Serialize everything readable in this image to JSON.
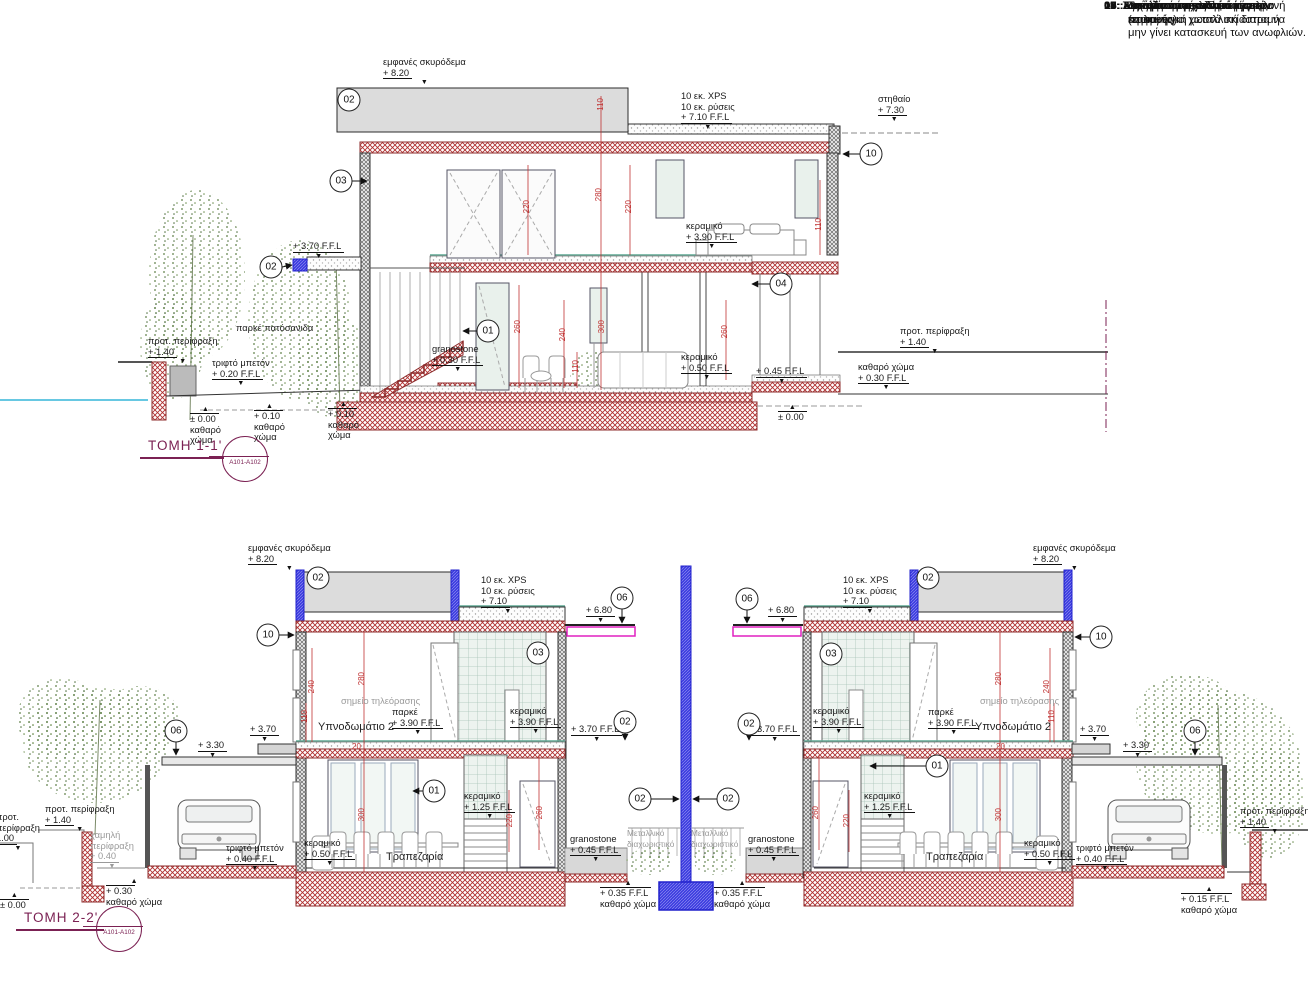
{
  "notes": {
    "items": [
      {
        "num": "04 :",
        "text": "Επένδυση φυσικής πέτρας επιλογής"
      },
      {
        "num": "05 :",
        "text": ":Διάτρητη τοιχοποιία."
      },
      {
        "num": "06:",
        "text": "Μεταλλικό στέγαστρο με εμφανή περιμετρική μεταλλική διατομή"
      },
      {
        "num": "07:",
        "text": "Συρόμενο μεταλλικό κάγκελο."
      },
      {
        "num": "08:",
        "text": "Ανοιγόμενο μεταλλικό κάγκελο."
      },
      {
        "num": "09:",
        "text": "Εγκατάσταση κουπαστής."
      },
      {
        "num": "10:",
        "text": "Σε περίπτωση εγκατάστασης κουτιών για χωστά σκίαστρα να μην γίνει κατασκευή των ανωφλιών."
      },
      {
        "num": "11:",
        "text": "Τοιχοία από σανιδωτό  μπετόν (εμφανές)"
      }
    ]
  },
  "sections": {
    "s1": {
      "title": "ΤΟΜΗ 1-1'",
      "ref": "A101-A102",
      "circles": [
        {
          "n": "02",
          "x": 349,
          "y": 100
        },
        {
          "n": "03",
          "x": 341,
          "y": 181
        },
        {
          "n": "02",
          "x": 271,
          "y": 267
        },
        {
          "n": "01",
          "x": 488,
          "y": 331
        },
        {
          "n": "04",
          "x": 781,
          "y": 284
        },
        {
          "n": "10",
          "x": 871,
          "y": 154
        }
      ],
      "levels": [
        {
          "name": "εμφανές σκυρόδεμα",
          "value": "+ 8.20",
          "x": 383,
          "y": 57,
          "marker": "down"
        },
        {
          "name": "10 εκ. XPS",
          "name2": "10 εκ. ρύσεις",
          "value": "+ 7.10 F.F.L",
          "x": 681,
          "y": 91,
          "marker": "down"
        },
        {
          "name": "στηθαίο",
          "value": "+ 7.30",
          "x": 878,
          "y": 94,
          "marker": "down"
        },
        {
          "value": "+ 3.70 F.F.L",
          "x": 293,
          "y": 241,
          "marker": "down"
        },
        {
          "name": "κεραμικό",
          "value": "+ 3.90 F.F.L",
          "x": 686,
          "y": 221,
          "marker": "down"
        },
        {
          "name": "κεραμικό",
          "value": "+ 0.50 F.F.L",
          "x": 681,
          "y": 352,
          "marker": "down"
        },
        {
          "value": "+ 0.45 F.F.L",
          "x": 756,
          "y": 366,
          "marker": "down"
        },
        {
          "name": "καθαρό χώμα",
          "value": "+ 0.30 F.F.L",
          "x": 858,
          "y": 362,
          "marker": "down"
        },
        {
          "name": "προτ. περίφραξη",
          "value": "+ 1.40",
          "x": 900,
          "y": 326,
          "marker": "down"
        },
        {
          "value": "± 0.00",
          "x": 778,
          "y": 404,
          "marker": "up"
        },
        {
          "name": "προτ. περίφραξη",
          "value": "+ 1.40",
          "x": 148,
          "y": 336,
          "marker": "down"
        },
        {
          "name": "τριφτό μπετόν",
          "value": "+ 0.20 F.F.L",
          "x": 212,
          "y": 358,
          "marker": "down"
        },
        {
          "name": "granostone",
          "value": "+ 0.30 F.F.L",
          "x": 432,
          "y": 344,
          "marker": "down"
        },
        {
          "value": "± 0.00",
          "below": "καθαρό",
          "below2": "χώμα",
          "x": 190,
          "y": 406,
          "marker": "up"
        },
        {
          "value": "+ 0.10",
          "below": "καθαρό",
          "below2": "χώμα",
          "x": 254,
          "y": 403,
          "marker": "up"
        },
        {
          "value": "+ 0.10",
          "below": "καθαρό",
          "below2": "χώμα",
          "x": 328,
          "y": 401,
          "marker": "up"
        }
      ],
      "dims": [
        {
          "v": "110",
          "x": 596,
          "y": 98,
          "rot": true
        },
        {
          "v": "220",
          "x": 522,
          "y": 200,
          "rot": true
        },
        {
          "v": "280",
          "x": 594,
          "y": 188,
          "rot": true
        },
        {
          "v": "220",
          "x": 624,
          "y": 200,
          "rot": true
        },
        {
          "v": "110",
          "x": 814,
          "y": 218,
          "rot": true
        },
        {
          "v": "260",
          "x": 513,
          "y": 320,
          "rot": true
        },
        {
          "v": "240",
          "x": 558,
          "y": 328,
          "rot": true
        },
        {
          "v": "110",
          "x": 571,
          "y": 360,
          "rot": true
        },
        {
          "v": "300",
          "x": 597,
          "y": 320,
          "rot": true
        },
        {
          "v": "260",
          "x": 720,
          "y": 325,
          "rot": true
        }
      ],
      "texts": [
        {
          "t": "παρκέ πατόσανιδα",
          "x": 236,
          "y": 323
        }
      ]
    },
    "s2": {
      "title": "ΤΟΜΗ 2-2'",
      "ref": "A101-A102",
      "circles": [
        {
          "n": "02",
          "x": 318,
          "y": 578
        },
        {
          "n": "10",
          "x": 268,
          "y": 635
        },
        {
          "n": "06",
          "x": 622,
          "y": 598
        },
        {
          "n": "06",
          "x": 176,
          "y": 731
        },
        {
          "n": "03",
          "x": 538,
          "y": 653
        },
        {
          "n": "01",
          "x": 434,
          "y": 791
        },
        {
          "n": "02",
          "x": 625,
          "y": 722
        },
        {
          "n": "02",
          "x": 640,
          "y": 799
        },
        {
          "n": "02",
          "x": 928,
          "y": 578
        },
        {
          "n": "10",
          "x": 1101,
          "y": 637
        },
        {
          "n": "06",
          "x": 747,
          "y": 599
        },
        {
          "n": "06",
          "x": 1195,
          "y": 731
        },
        {
          "n": "03",
          "x": 831,
          "y": 654
        },
        {
          "n": "01",
          "x": 937,
          "y": 766
        },
        {
          "n": "02",
          "x": 749,
          "y": 724
        },
        {
          "n": "02",
          "x": 728,
          "y": 799
        }
      ],
      "levels": [
        {
          "name": "εμφανές σκυρόδεμα",
          "value": "+ 8.20",
          "x": 248,
          "y": 543,
          "marker": "down"
        },
        {
          "name": "10 εκ. XPS",
          "name2": "10 εκ. ρύσεις",
          "value": "+ 7.10",
          "x": 481,
          "y": 575,
          "marker": "down"
        },
        {
          "value": "+ 6.80",
          "x": 586,
          "y": 605,
          "marker": "down"
        },
        {
          "value": "+ 3.70",
          "x": 250,
          "y": 724,
          "marker": "down"
        },
        {
          "value": "+ 3.30",
          "x": 198,
          "y": 740,
          "marker": "down"
        },
        {
          "name": "παρκέ",
          "value": "+ 3.90 F.F.L",
          "x": 392,
          "y": 707,
          "marker": "down"
        },
        {
          "name": "κεραμικό",
          "value": "+ 3.90 F.F.L",
          "x": 510,
          "y": 706,
          "marker": "down"
        },
        {
          "value": "+ 3.70 F.F.L",
          "x": 571,
          "y": 724,
          "marker": "down"
        },
        {
          "name": "κεραμικό",
          "value": "+ 1.25 F.F.L",
          "x": 464,
          "y": 791,
          "marker": "down"
        },
        {
          "name": "κεραμικό",
          "value": "+ 0.50 F.F.L",
          "x": 304,
          "y": 838,
          "marker": "down"
        },
        {
          "name": "τριφτό μπετόν",
          "value": "+ 0.40 F.F.L",
          "x": 226,
          "y": 843,
          "marker": "down"
        },
        {
          "name": "granostone",
          "value": "+ 0.45 F.F.L",
          "x": 570,
          "y": 834,
          "marker": "down"
        },
        {
          "value": "+ 0.35 F.F.L",
          "below": "καθαρό χώμα",
          "x": 600,
          "y": 880,
          "marker": "up"
        },
        {
          "name": "προτ. περίφραξη",
          "value": "+ 1.40",
          "x": 45,
          "y": 804,
          "marker": "down"
        },
        {
          "name": "προτ.",
          "name2": "περίφραξη",
          "value": "1.00",
          "x": -4,
          "y": 812,
          "marker": "down"
        },
        {
          "name": "χαμηλή",
          "name2": "περίφραξη",
          "value": "+ 0.40",
          "x": 90,
          "y": 830,
          "cls": "gray",
          "marker": "down"
        },
        {
          "value": "+ 0.30",
          "below": "καθαρό χώμα",
          "x": 106,
          "y": 878,
          "marker": "up"
        },
        {
          "value": "± 0.00",
          "x": 0,
          "y": 892,
          "marker": "up"
        },
        {
          "name": "εμφανές σκυρόδεμα",
          "value": "+ 8.20",
          "x": 1033,
          "y": 543,
          "marker": "down"
        },
        {
          "name": "10 εκ. XPS",
          "name2": "10 εκ. ρύσεις",
          "value": "+ 7.10",
          "x": 843,
          "y": 575,
          "marker": "down"
        },
        {
          "value": "+ 6.80",
          "x": 768,
          "y": 605,
          "marker": "down"
        },
        {
          "value": "+ 3.70 F.F.L",
          "x": 749,
          "y": 724,
          "marker": "down"
        },
        {
          "name": "κεραμικό",
          "value": "+ 3.90 F.F.L",
          "x": 813,
          "y": 706,
          "marker": "down"
        },
        {
          "name": "παρκέ",
          "value": "+ 3.90 F.F.L",
          "x": 928,
          "y": 707,
          "marker": "down"
        },
        {
          "value": "+ 3.70",
          "x": 1080,
          "y": 724,
          "marker": "down"
        },
        {
          "value": "+ 3.30",
          "x": 1123,
          "y": 740,
          "marker": "down"
        },
        {
          "name": "κεραμικό",
          "value": "+ 1.25 F.F.L",
          "x": 864,
          "y": 791,
          "marker": "down"
        },
        {
          "name": "κεραμικό",
          "value": "+ 0.50 F.F.L",
          "x": 1024,
          "y": 838,
          "marker": "down"
        },
        {
          "name": "τριφτό μπετόν",
          "value": "+ 0.40 F.F.L",
          "x": 1076,
          "y": 843,
          "marker": "down"
        },
        {
          "name": "granostone",
          "value": "+ 0.45 F.F.L",
          "x": 748,
          "y": 834,
          "marker": "down"
        },
        {
          "value": "+ 0.35 F.F.L",
          "below": "καθαρό χώμα",
          "x": 714,
          "y": 880,
          "marker": "up"
        },
        {
          "name": "προτ. περίφραξη",
          "value": "+ 1.40",
          "x": 1240,
          "y": 806,
          "marker": "down"
        },
        {
          "value": "+ 0.15 F.F.L",
          "below": "καθαρό χώμα",
          "x": 1181,
          "y": 886,
          "marker": "up"
        }
      ],
      "dims": [
        {
          "v": "240",
          "x": 307,
          "y": 680,
          "rot": true
        },
        {
          "v": "110",
          "x": 300,
          "y": 710,
          "rot": true
        },
        {
          "v": "280",
          "x": 357,
          "y": 672,
          "rot": true
        },
        {
          "v": "20",
          "x": 352,
          "y": 742
        },
        {
          "v": "300",
          "x": 357,
          "y": 808,
          "rot": true
        },
        {
          "v": "220",
          "x": 505,
          "y": 814,
          "rot": true
        },
        {
          "v": "260",
          "x": 535,
          "y": 806,
          "rot": true
        },
        {
          "v": "280",
          "x": 994,
          "y": 672,
          "rot": true
        },
        {
          "v": "240",
          "x": 1042,
          "y": 680,
          "rot": true
        },
        {
          "v": "110",
          "x": 1047,
          "y": 710,
          "rot": true
        },
        {
          "v": "20",
          "x": 996,
          "y": 742
        },
        {
          "v": "300",
          "x": 994,
          "y": 808,
          "rot": true
        },
        {
          "v": "220",
          "x": 842,
          "y": 814,
          "rot": true
        },
        {
          "v": "260",
          "x": 811,
          "y": 806,
          "rot": true
        }
      ],
      "texts": [
        {
          "t": "σημείο τηλεόρασης",
          "x": 341,
          "y": 696,
          "cls": "gray"
        },
        {
          "t": "Υπνοδωμάτιο 2",
          "x": 318,
          "y": 722,
          "cls": "room"
        },
        {
          "t": "Τραπεζαρία",
          "x": 386,
          "y": 852,
          "cls": "room"
        },
        {
          "t": "Μεταλλικό",
          "t2": "διαχωριστικό",
          "x": 627,
          "y": 828,
          "cls": "tiny"
        },
        {
          "t": "Μεταλλικό",
          "t2": "διαχωριστικό",
          "x": 691,
          "y": 828,
          "cls": "tiny"
        },
        {
          "t": "σημείο τηλεόρασης",
          "x": 980,
          "y": 696,
          "cls": "gray"
        },
        {
          "t": "Υπνοδωμάτιο 2",
          "x": 975,
          "y": 722,
          "cls": "room"
        },
        {
          "t": "Τραπεζαρία",
          "x": 926,
          "y": 852,
          "cls": "room"
        }
      ]
    }
  }
}
